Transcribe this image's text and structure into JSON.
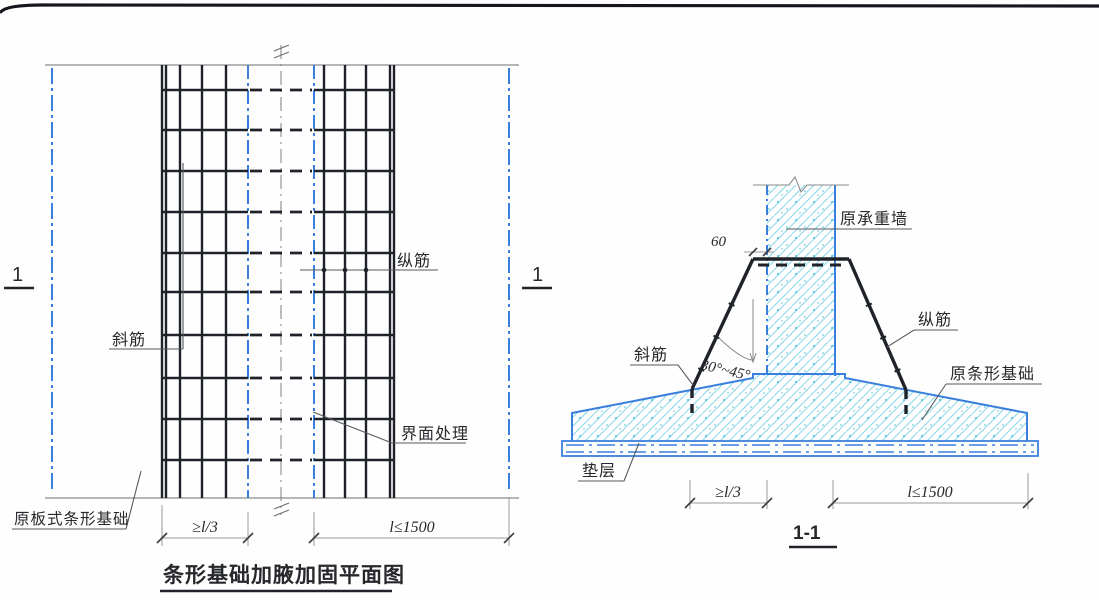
{
  "drawing": {
    "plan": {
      "title": "条形基础加腋加固平面图",
      "section_mark": "1",
      "label_diagonal_bar": "斜筋",
      "label_longitudinal_bar": "纵筋",
      "label_interface_treatment": "界面处理",
      "label_original_slab_strip_foundation": "原板式条形基础",
      "dim_left": "≥l/3",
      "dim_right": "l≤1500"
    },
    "section": {
      "title": "1-1",
      "label_original_bearing_wall": "原承重墙",
      "label_longitudinal_bar": "纵筋",
      "label_diagonal_bar": "斜筋",
      "label_angle_range": "30°~45°",
      "label_original_strip_foundation": "原条形基础",
      "label_bedding_layer": "垫层",
      "dim_offset": "60",
      "dim_left": "≥l/3",
      "dim_right": "l≤1500"
    },
    "colors": {
      "blue_line": "#3a7fdd",
      "cyan_hatch": "#8fd8ea",
      "cyan_dot": "#45bedd",
      "black_line": "#1f2329",
      "gray_line": "#8a8a8a",
      "frame": "#14181d"
    }
  }
}
